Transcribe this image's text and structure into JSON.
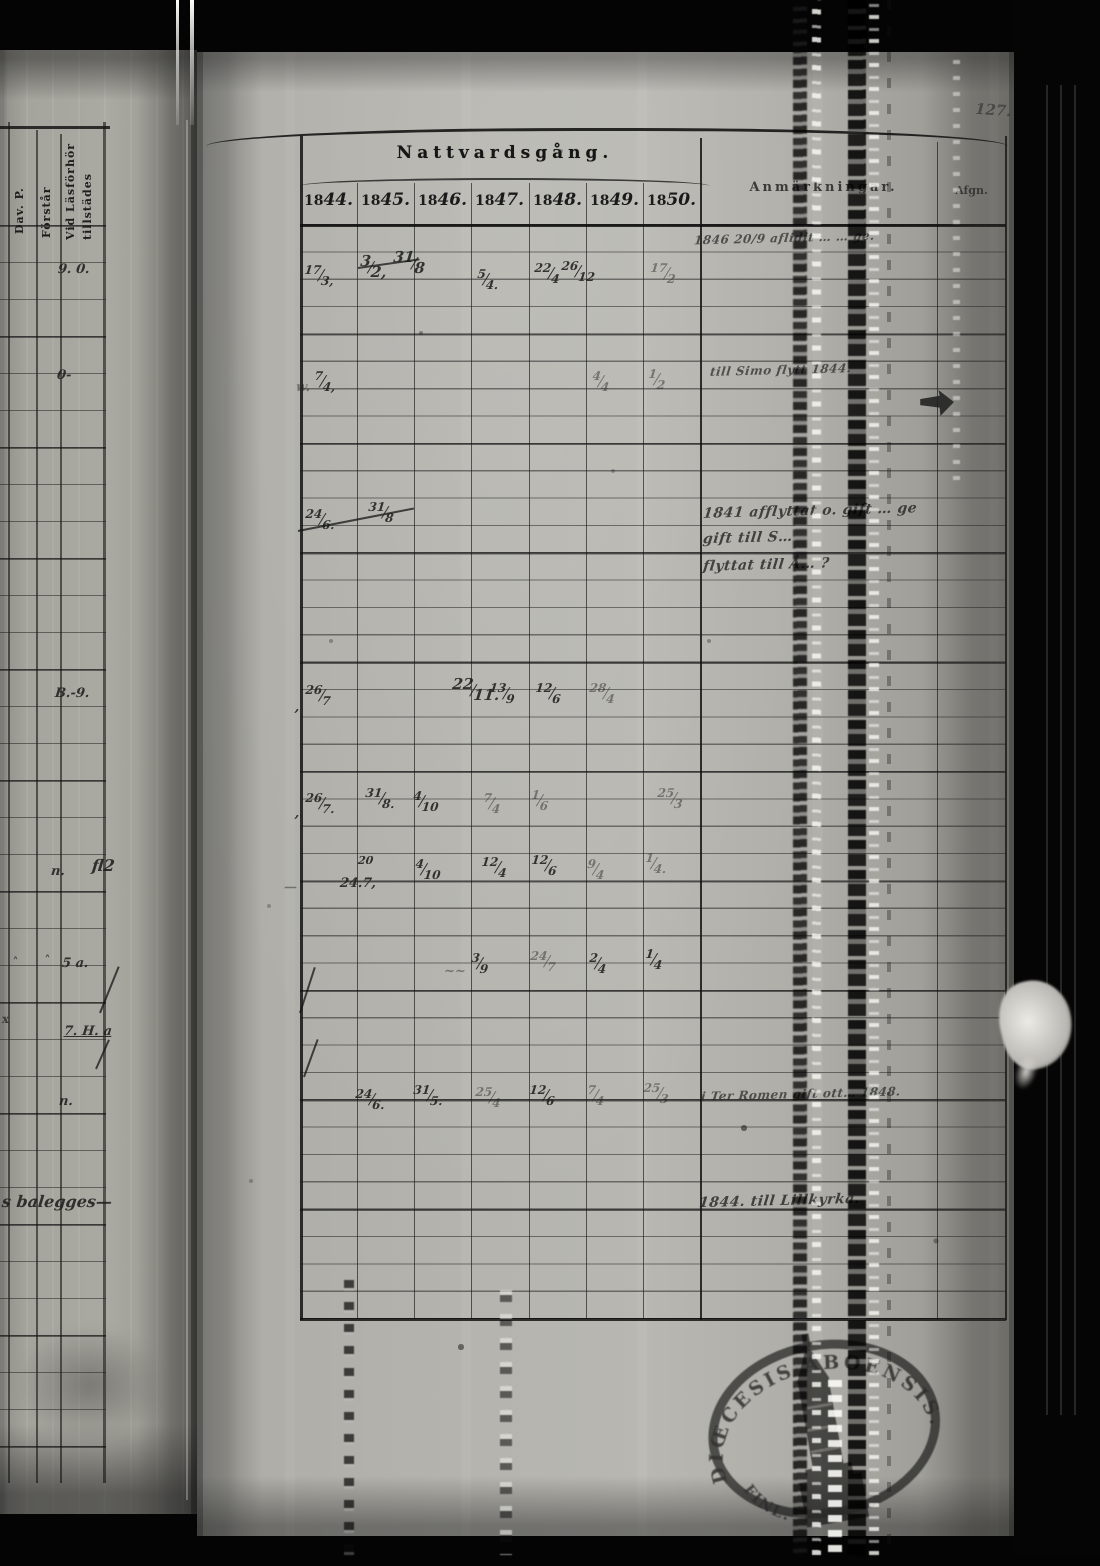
{
  "page_number": "127.",
  "header": {
    "title": "Nattvardsgång.",
    "years": [
      {
        "printed": "18",
        "written": "44."
      },
      {
        "printed": "18",
        "written": "45."
      },
      {
        "printed": "18",
        "written": "46."
      },
      {
        "printed": "18",
        "written": "47."
      },
      {
        "printed": "18",
        "written": "48."
      },
      {
        "printed": "18",
        "written": "49."
      },
      {
        "printed": "18",
        "written": "50."
      }
    ],
    "remarks_label": "Anmärkningar.",
    "departed_label": "Afgn."
  },
  "left_page": {
    "col_headers": [
      "Dav. P.",
      "Förstår",
      "Vid Läsförhör",
      "tillstädes"
    ],
    "entries": [
      {
        "x": 58,
        "y": 262,
        "t": "9. 0."
      },
      {
        "x": 57,
        "y": 368,
        "t": "0-"
      },
      {
        "x": 55,
        "y": 686,
        "t": "B.-9."
      },
      {
        "x": 51,
        "y": 864,
        "t": "n."
      },
      {
        "x": 92,
        "y": 856,
        "t": "fl2",
        "cls": "big"
      },
      {
        "x": 12,
        "y": 955,
        "t": "˄",
        "cls": "mark"
      },
      {
        "x": 44,
        "y": 953,
        "t": "˄",
        "cls": "mark"
      },
      {
        "x": 62,
        "y": 956,
        "t": "5 a."
      },
      {
        "x": 2,
        "y": 1012,
        "t": "x",
        "cls": "mark"
      },
      {
        "x": 64,
        "y": 1024,
        "t": "7. H. a",
        "cls": "u"
      },
      {
        "x": 59,
        "y": 1094,
        "t": "n."
      },
      {
        "x": 2,
        "y": 1192,
        "t": "s balegges—",
        "cls": "big"
      }
    ]
  },
  "records": [
    {
      "x": 304,
      "y": 266,
      "n": "17",
      "d": "3,"
    },
    {
      "x": 360,
      "y": 257,
      "n": "3",
      "d": "2,",
      "cls": "big"
    },
    {
      "x": 393,
      "y": 253,
      "n": "31",
      "d": "8",
      "cls": "big"
    },
    {
      "x": 477,
      "y": 270,
      "n": "5",
      "d": "4."
    },
    {
      "x": 534,
      "y": 264,
      "n": "22",
      "d": "4"
    },
    {
      "x": 561,
      "y": 262,
      "n": "26",
      "d": "12"
    },
    {
      "x": 650,
      "y": 264,
      "n": "17",
      "d": "2",
      "cls": "faint"
    },
    {
      "x": 296,
      "y": 380,
      "t": "w.",
      "cls": "faint"
    },
    {
      "x": 314,
      "y": 372,
      "n": "7",
      "d": "4,"
    },
    {
      "x": 592,
      "y": 372,
      "n": "4",
      "d": "4",
      "cls": "faint"
    },
    {
      "x": 648,
      "y": 370,
      "n": "1",
      "d": "2",
      "cls": "faint"
    },
    {
      "x": 305,
      "y": 510,
      "n": "24",
      "d": "6."
    },
    {
      "x": 368,
      "y": 503,
      "n": "31",
      "d": "8"
    },
    {
      "x": 295,
      "y": 700,
      "t": ","
    },
    {
      "x": 305,
      "y": 686,
      "n": "26",
      "d": "7"
    },
    {
      "x": 452,
      "y": 680,
      "n": "22",
      "d": "11.",
      "cls": "big"
    },
    {
      "x": 489,
      "y": 684,
      "n": "13",
      "d": "9"
    },
    {
      "x": 535,
      "y": 684,
      "n": "12",
      "d": "6"
    },
    {
      "x": 589,
      "y": 684,
      "n": "28",
      "d": "4",
      "cls": "faint"
    },
    {
      "x": 295,
      "y": 806,
      "t": ","
    },
    {
      "x": 305,
      "y": 794,
      "n": "26",
      "d": "7."
    },
    {
      "x": 365,
      "y": 789,
      "n": "31",
      "d": "8."
    },
    {
      "x": 413,
      "y": 792,
      "n": "4",
      "d": "10"
    },
    {
      "x": 483,
      "y": 794,
      "n": "7",
      "d": "4",
      "cls": "faint"
    },
    {
      "x": 531,
      "y": 791,
      "n": "1",
      "d": "6",
      "cls": "faint"
    },
    {
      "x": 657,
      "y": 789,
      "n": "25",
      "d": "3",
      "cls": "faint"
    },
    {
      "x": 284,
      "y": 880,
      "t": "—",
      "cls": "faint"
    },
    {
      "x": 358,
      "y": 854,
      "t": "20",
      "cls": "sup"
    },
    {
      "x": 340,
      "y": 876,
      "t": "24.7,"
    },
    {
      "x": 415,
      "y": 860,
      "n": "4",
      "d": "10"
    },
    {
      "x": 481,
      "y": 858,
      "n": "12",
      "d": "4"
    },
    {
      "x": 531,
      "y": 856,
      "n": "12",
      "d": "6"
    },
    {
      "x": 587,
      "y": 860,
      "n": "9",
      "d": "4",
      "cls": "faint"
    },
    {
      "x": 645,
      "y": 854,
      "n": "1",
      "d": "4.",
      "cls": "faint"
    },
    {
      "x": 444,
      "y": 964,
      "t": "~~",
      "cls": "faint"
    },
    {
      "x": 471,
      "y": 954,
      "n": "3",
      "d": "9"
    },
    {
      "x": 530,
      "y": 952,
      "n": "24",
      "d": "7",
      "cls": "faint"
    },
    {
      "x": 589,
      "y": 954,
      "n": "2",
      "d": "4"
    },
    {
      "x": 645,
      "y": 950,
      "n": "1",
      "d": "4"
    },
    {
      "x": 355,
      "y": 1090,
      "n": "24",
      "d": "6."
    },
    {
      "x": 413,
      "y": 1086,
      "n": "31",
      "d": "5."
    },
    {
      "x": 475,
      "y": 1088,
      "n": "25",
      "d": "4",
      "cls": "faint"
    },
    {
      "x": 529,
      "y": 1086,
      "n": "12",
      "d": "6"
    },
    {
      "x": 587,
      "y": 1086,
      "n": "7",
      "d": "4",
      "cls": "faint"
    },
    {
      "x": 643,
      "y": 1084,
      "n": "25",
      "d": "3",
      "cls": "faint"
    }
  ],
  "annotations": [
    {
      "x": 694,
      "y": 231,
      "t": "1846 20/9 aflidit … … ge.",
      "cls": "sm"
    },
    {
      "x": 710,
      "y": 363,
      "t": "till Simo flytt 1844.",
      "cls": "sm"
    },
    {
      "x": 703,
      "y": 503,
      "t": "1841 afflyttat o. gift … ge"
    },
    {
      "x": 703,
      "y": 530,
      "t": "gift till S…"
    },
    {
      "x": 703,
      "y": 557,
      "t": "flyttat till Å… ?"
    },
    {
      "x": 701,
      "y": 1087,
      "t": "i Ter Romen gift ott… 1848.",
      "cls": "sm"
    },
    {
      "x": 699,
      "y": 1193,
      "t": "1844. till Lillkyrka."
    }
  ],
  "strokes": [
    {
      "x": 358,
      "y": 267,
      "w": 62,
      "r": -8
    },
    {
      "x": 298,
      "y": 530,
      "w": 118,
      "r": -11
    },
    {
      "x": 300,
      "y": 1012,
      "w": 48,
      "r": -72
    },
    {
      "x": 304,
      "y": 1076,
      "w": 40,
      "r": -70
    },
    {
      "x": 100,
      "y": 1012,
      "w": 50,
      "r": -68
    },
    {
      "x": 96,
      "y": 1068,
      "w": 32,
      "r": -66
    }
  ],
  "stamp": {
    "text_top": "DIŒCESIS ABOENSIS. MAG.",
    "text_bottom": "FINL.",
    "emblem": "church-tower"
  }
}
